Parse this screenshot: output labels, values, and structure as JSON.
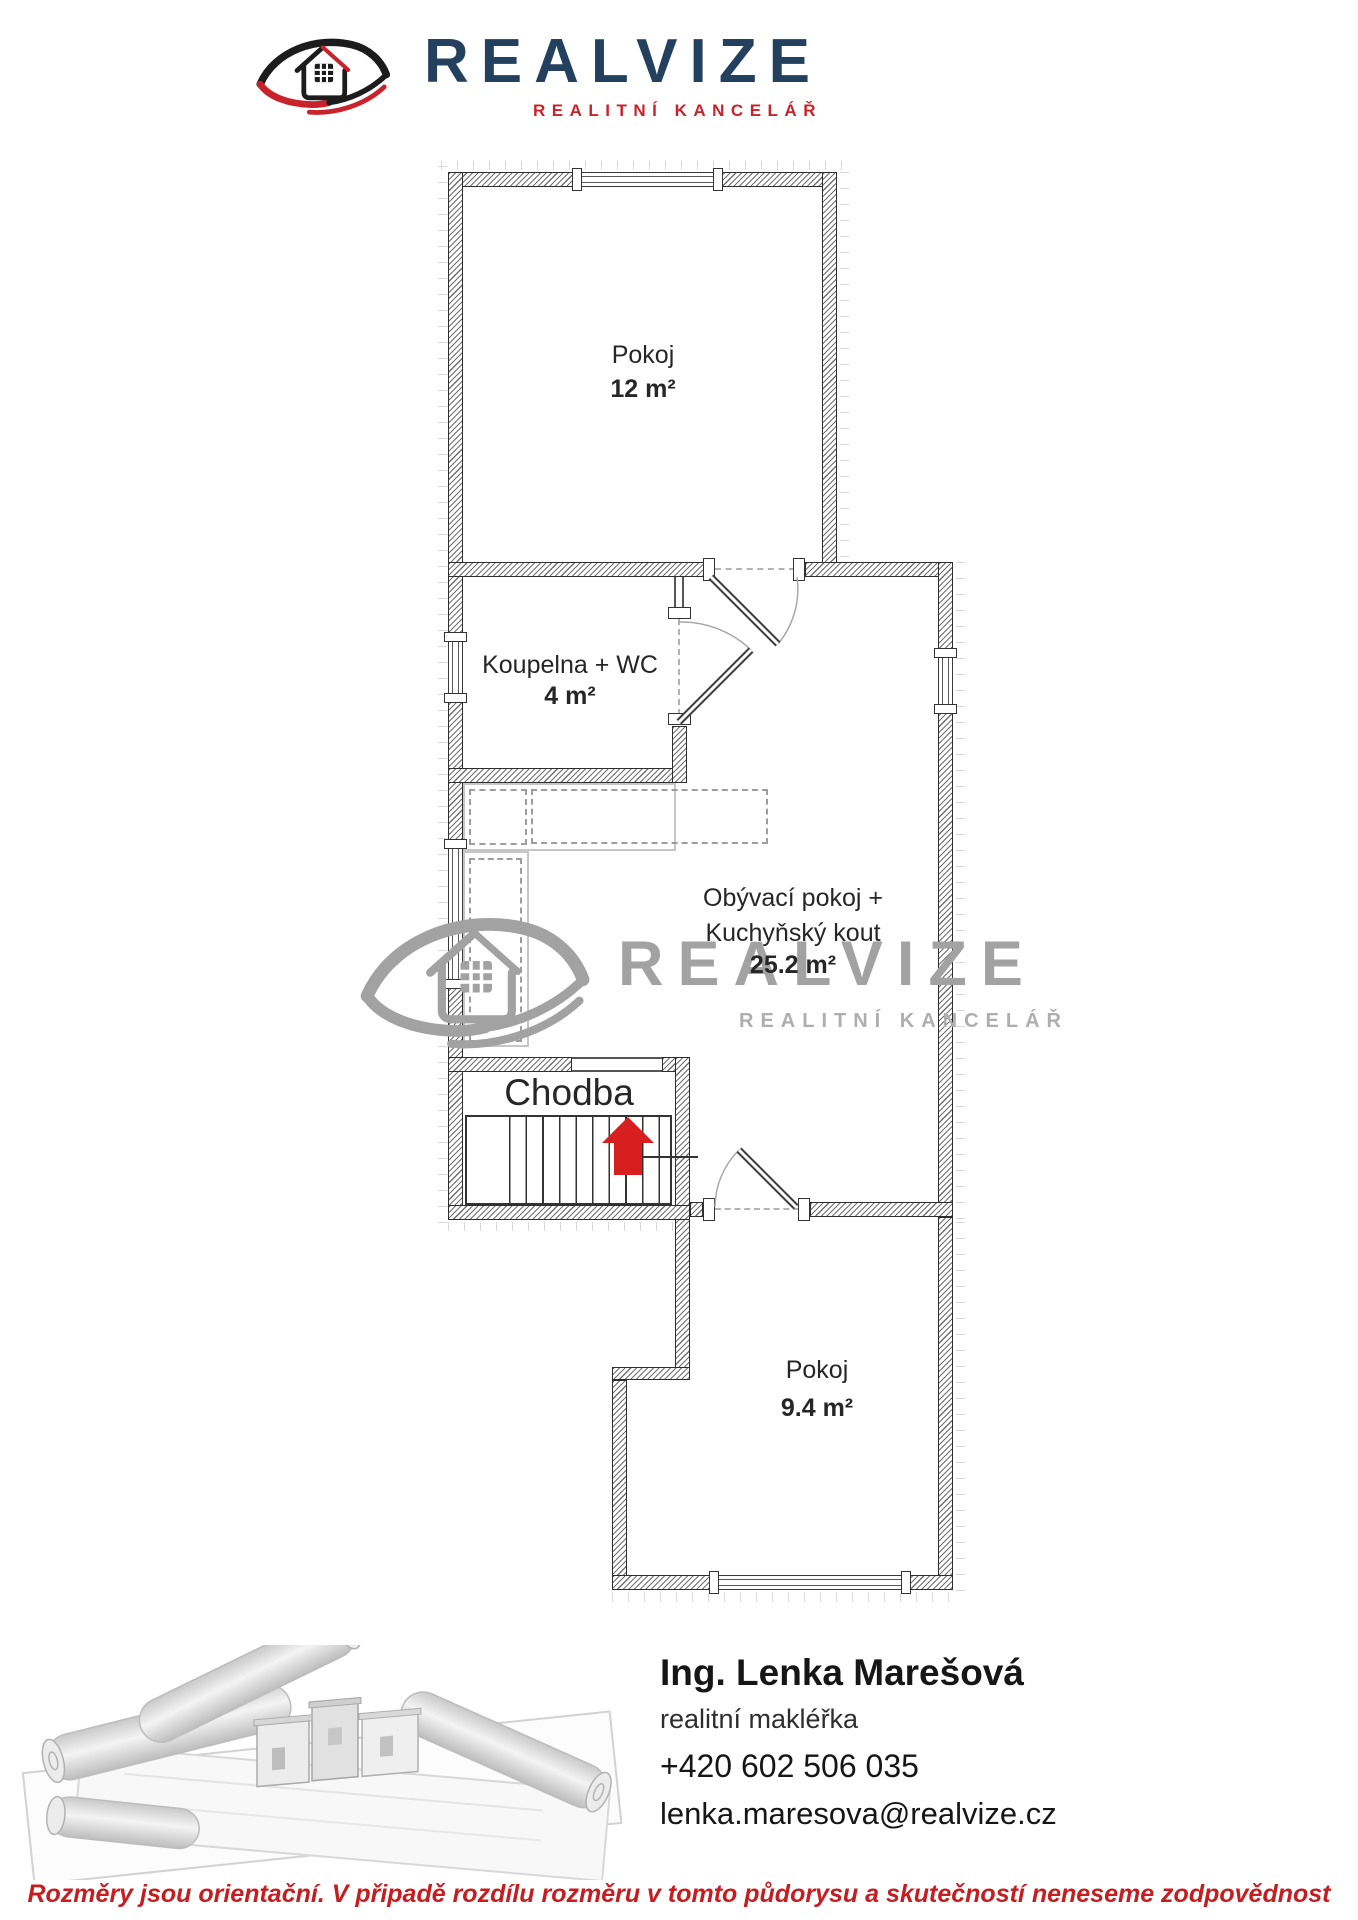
{
  "header": {
    "brand": "REALVIZE",
    "tagline": "REALITNÍ KANCELÁŘ"
  },
  "colors": {
    "brand_navy": "#24405f",
    "brand_red": "#c8232a",
    "arrow_red": "#d81f1f",
    "watermark_gray": "#a2a2a2",
    "disclaimer_red": "#c41e20"
  },
  "rooms": {
    "top": {
      "name": "Pokoj",
      "area": "12 m²"
    },
    "bath": {
      "name": "Koupelna + WC",
      "area": "4 m²"
    },
    "living": {
      "line1": "Obývací pokoj +",
      "line2": "Kuchyňský kout",
      "area": "25.2 m²"
    },
    "hall": {
      "name": "Chodba"
    },
    "bottom": {
      "name": "Pokoj",
      "area": "9.4 m²"
    }
  },
  "watermark": {
    "brand": "REALVIZE",
    "tagline": "REALITNÍ KANCELÁŘ"
  },
  "agent": {
    "name": "Ing. Lenka Marešová",
    "role": "realitní makléřka",
    "phone": "+420 602 506 035",
    "email": "lenka.maresova@realvize.cz"
  },
  "disclaimer": "Rozměry jsou orientační. V připadě rozdílu rozměru v tomto půdorysu a skutečností neneseme zodpovědnost"
}
